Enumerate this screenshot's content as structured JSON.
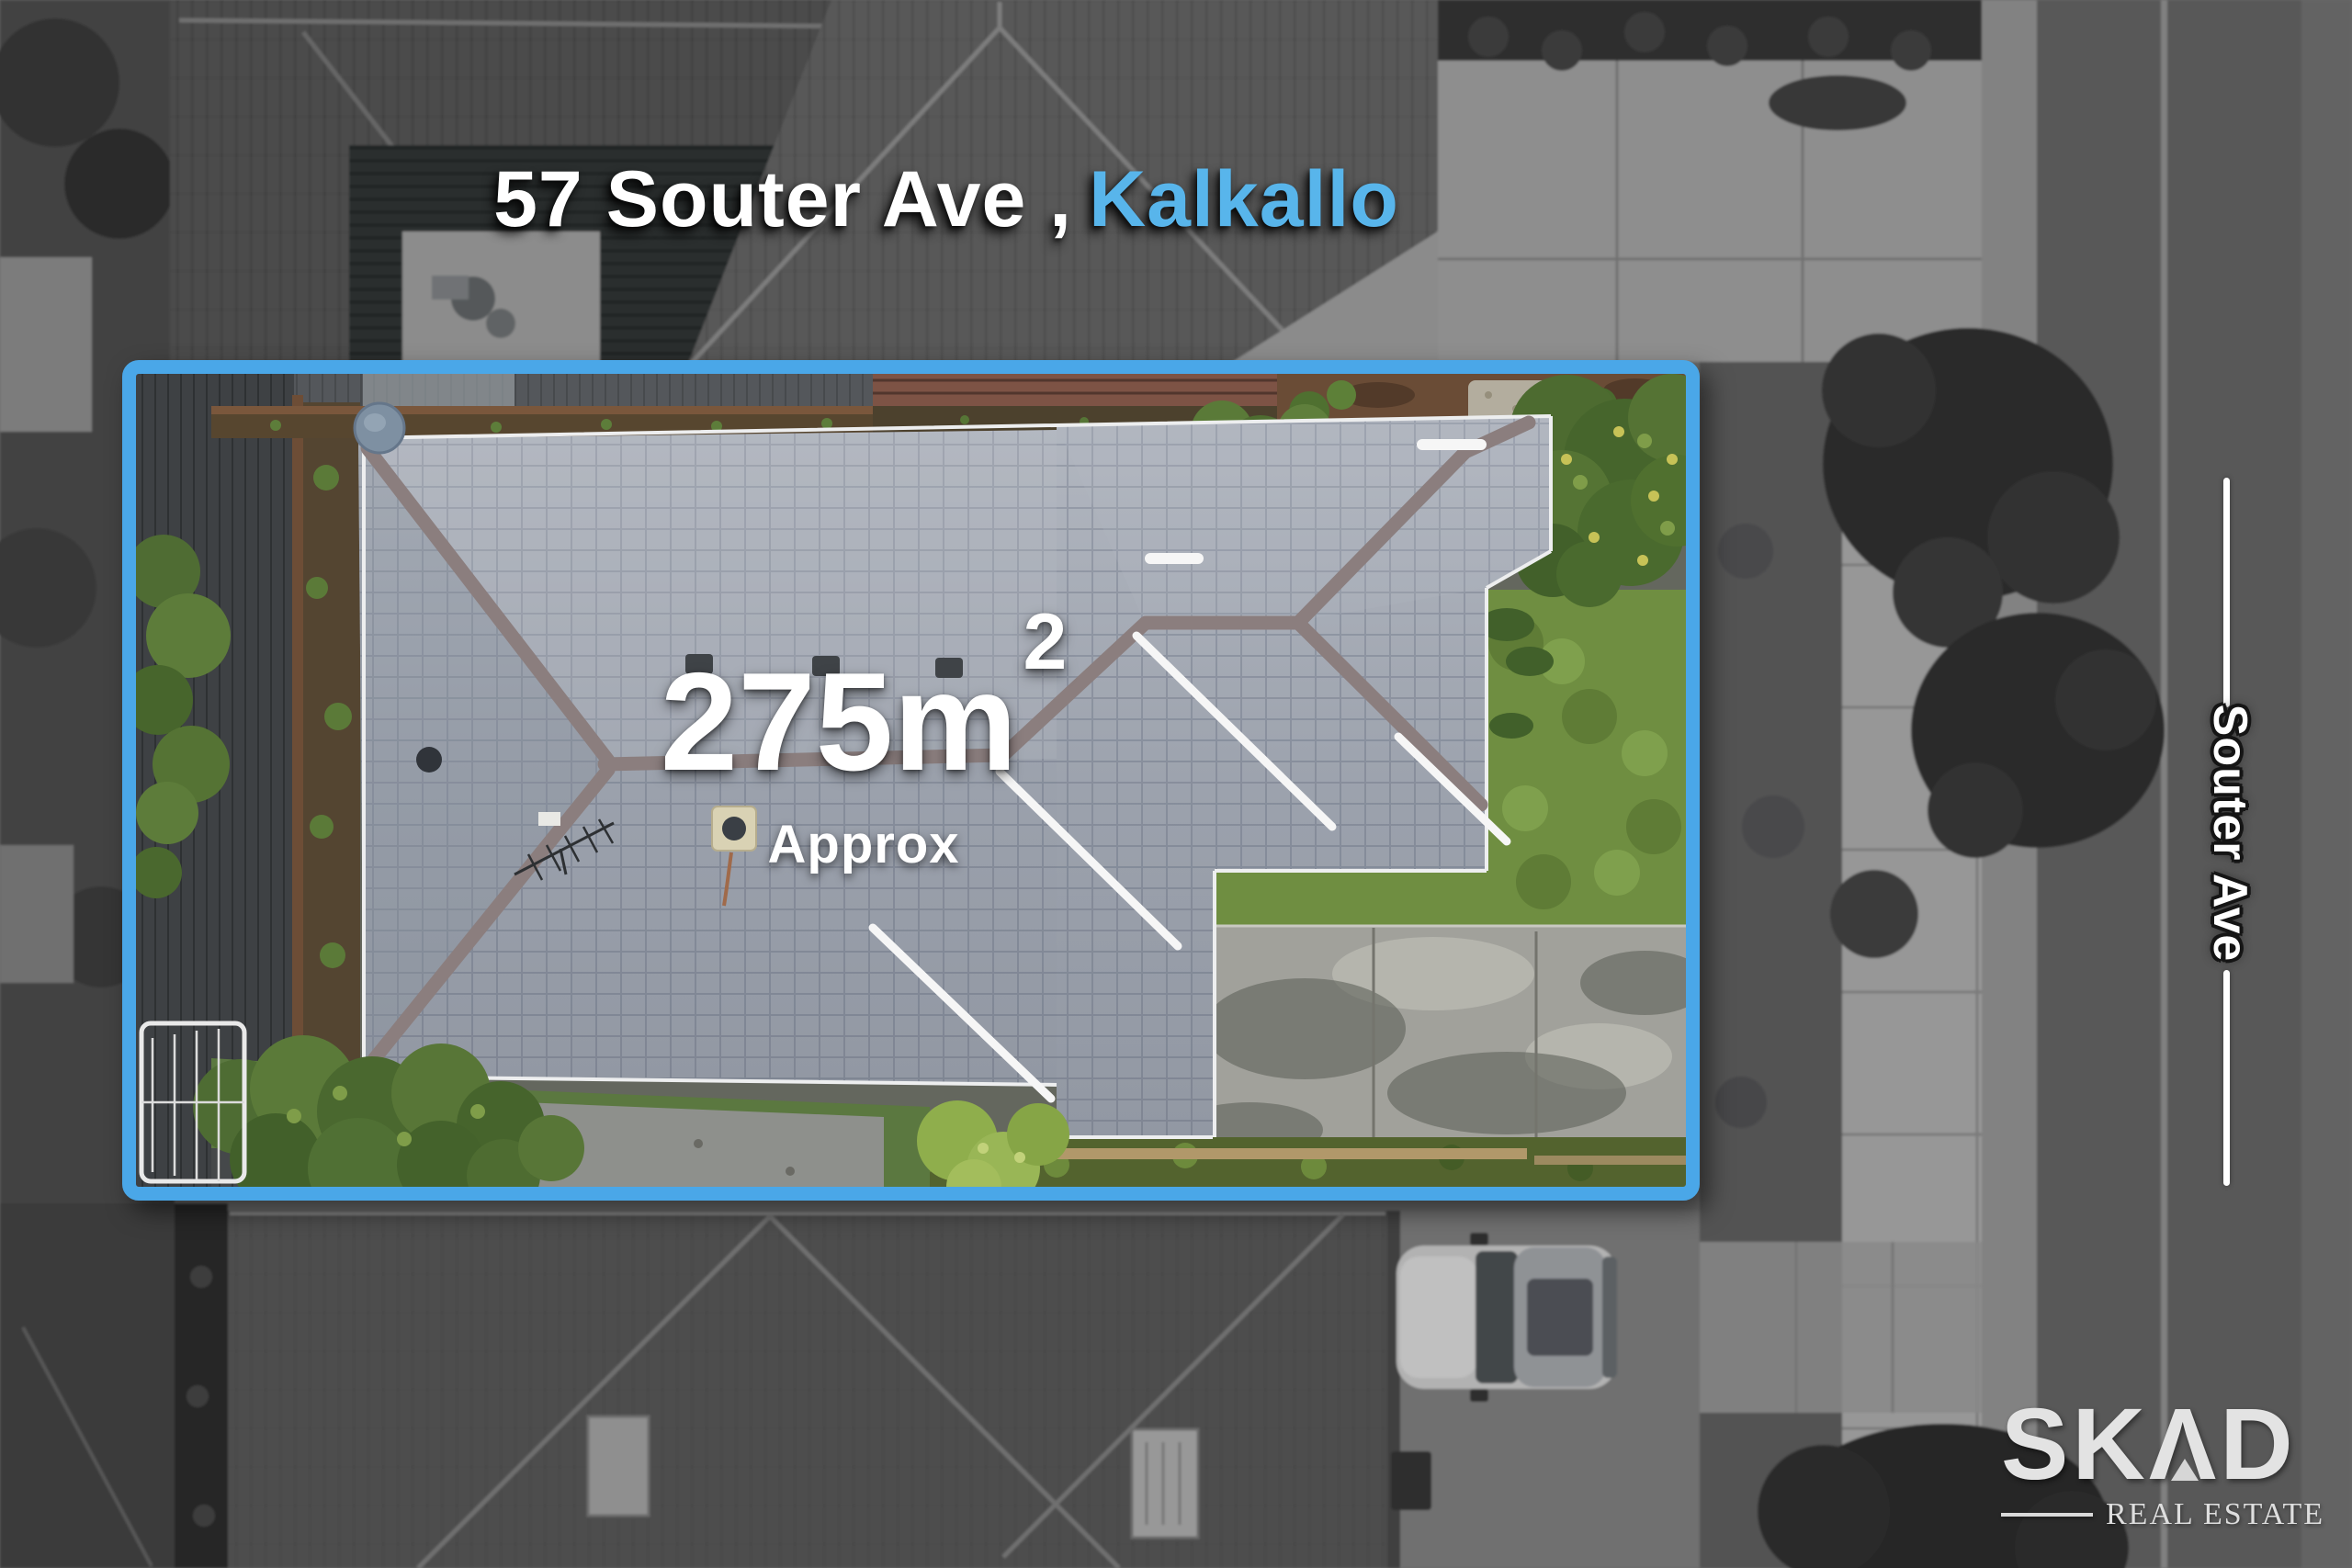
{
  "header": {
    "address": "57 Souter Ave ,",
    "suburb": "Kalkallo"
  },
  "area_label": {
    "value": "275m",
    "exponent": "2",
    "qualifier": "Approx"
  },
  "street": {
    "name": "Souter Ave"
  },
  "logo": {
    "part1": "SK",
    "part2": "Λ",
    "part3": "D",
    "tagline": "REAL ESTATE"
  },
  "colors": {
    "boundary_blue": "#4AA7E8",
    "suburb_blue": "#58B5EB",
    "text_white": "#FFFFFF",
    "logo_light": "#E3E3E3",
    "roof_tile_gray": "#A4ABB5",
    "ridge_taupe": "#8B7E7E",
    "lawn_green": "#6F8E41",
    "bush_green": "#4F6E32",
    "mulch_brown": "#6A4C36",
    "driveway_gray": "#A2A29B"
  }
}
